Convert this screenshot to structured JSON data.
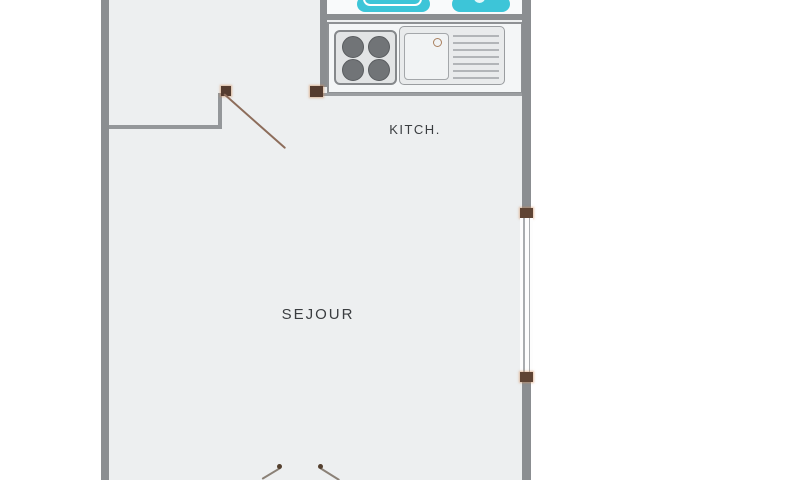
{
  "rooms": {
    "sejour": {
      "label": "SEJOUR"
    },
    "kitchen": {
      "label": "KITCH."
    }
  },
  "fixtures": [
    {
      "name": "bathtub",
      "color": "#3dc5d8"
    },
    {
      "name": "bathroom-appliance",
      "color": "#3dc5d8"
    },
    {
      "name": "cooktop-4-burners",
      "burners": 4
    },
    {
      "name": "kitchen-sink-with-drainer",
      "drainer_lines": 7
    },
    {
      "name": "window-right-wall"
    },
    {
      "name": "interior-door-swing"
    },
    {
      "name": "entry-double-door-swing"
    }
  ],
  "colors": {
    "outside": "#ffffff",
    "floor": "#edeff0",
    "wall": "#8b8e91",
    "partition": "#94979a",
    "fixture_cyan": "#3dc5d8",
    "door_wood": "#8d6d5b",
    "hinge_brown": "#553c2f",
    "window_frame": "#a9acaf",
    "counter_border": "#8e9194",
    "label_text": "#3a3d40"
  }
}
